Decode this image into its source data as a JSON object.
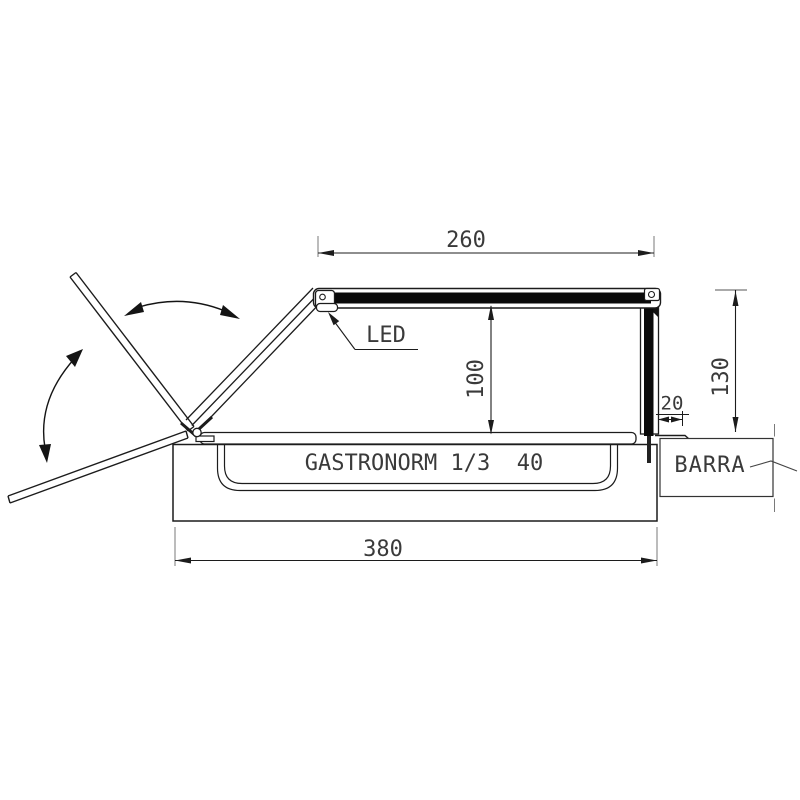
{
  "labels": {
    "led": "LED",
    "gastronorm": "GASTRONORM 1/3  40",
    "barra": "BARRA"
  },
  "dimensions": {
    "top_width": "260",
    "glass_height": "100",
    "right_height": "130",
    "bar_gap": "20",
    "base_width": "380"
  },
  "colors": {
    "line": "#1c1c1c",
    "text": "#3a3a3a",
    "extension_line": "#7a7a7a",
    "glass_fill": "#0a0a0a",
    "background": "#ffffff"
  }
}
